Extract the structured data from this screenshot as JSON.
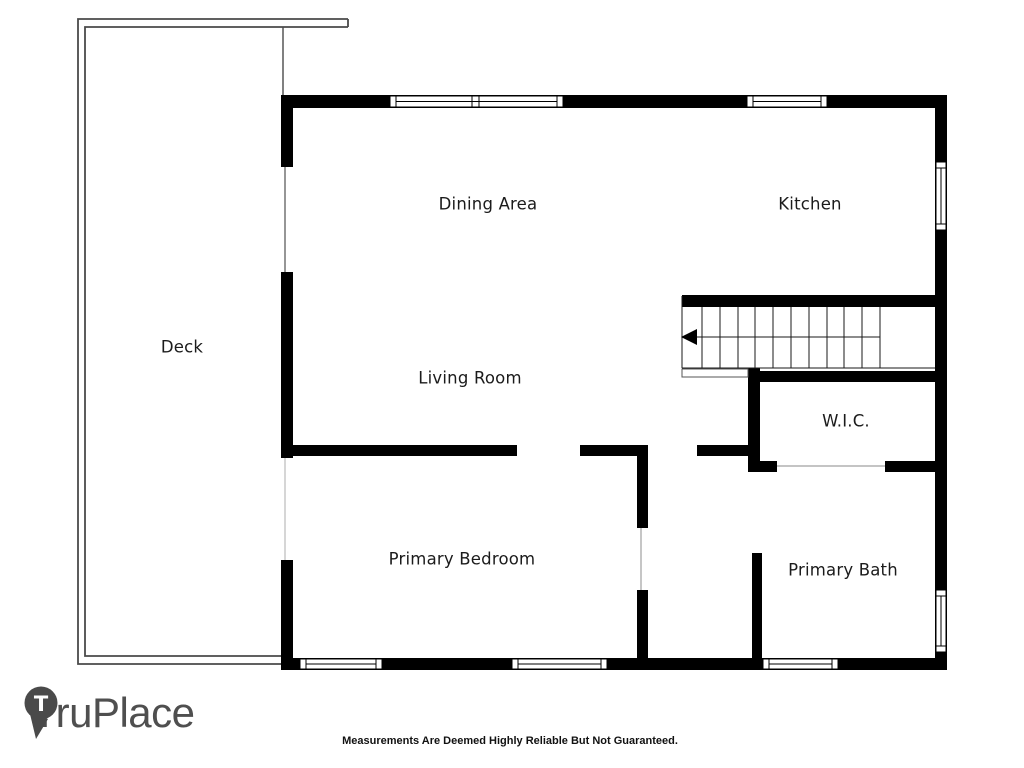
{
  "floor_plan": {
    "rooms": {
      "deck": {
        "label": "Deck"
      },
      "dining_area": {
        "label": "Dining Area"
      },
      "kitchen": {
        "label": "Kitchen"
      },
      "living_room": {
        "label": "Living Room"
      },
      "wic": {
        "label": "W.I.C."
      },
      "primary_bedroom": {
        "label": "Primary Bedroom"
      },
      "primary_bath": {
        "label": "Primary Bath"
      }
    },
    "stairs": {
      "direction": "left",
      "tread_count": 12
    }
  },
  "branding": {
    "name": "TruPlace",
    "logo_letter": "T",
    "logo_color": "#4a4a4a",
    "text_color": "#4f4f4f"
  },
  "disclaimer": "Measurements Are Deemed Highly Reliable But Not Guaranteed.",
  "colors": {
    "wall": "#000000",
    "background": "#ffffff",
    "label_text": "#1b1b1b",
    "deck_outline": "#4a4a4a"
  }
}
